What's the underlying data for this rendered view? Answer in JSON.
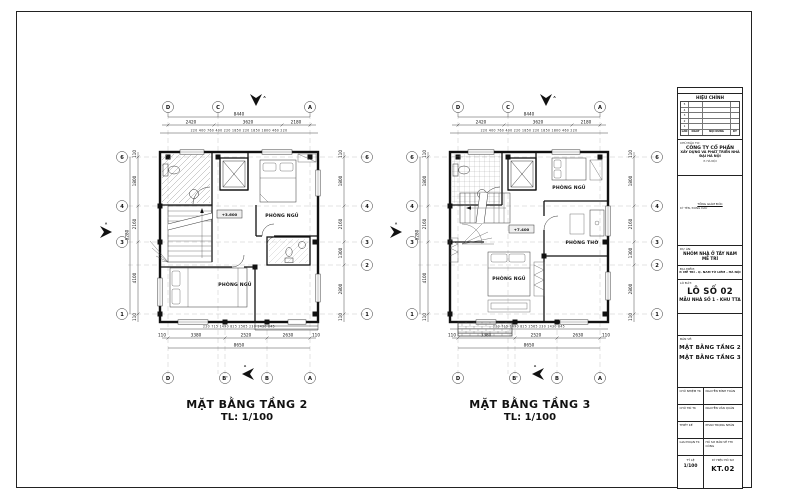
{
  "plans": [
    {
      "title": "MẶT BẰNG TẦNG 2",
      "scale": "TL: 1/100",
      "elevation": "+3.600",
      "section_label": "A",
      "rooms": {
        "bedroom1": "PHÒNG NGỦ",
        "bedroom2": "PHÒNG NGỦ"
      },
      "grid_top": [
        "D",
        "C",
        "A"
      ],
      "grid_bottom": [
        "D",
        "B'",
        "B",
        "A"
      ],
      "grid_left": [
        "6",
        "4",
        "3",
        "1"
      ],
      "grid_right": [
        "6",
        "4",
        "3",
        "2",
        "1"
      ],
      "dim_top_total": "8440",
      "dim_top_segments": [
        "2420",
        "3620",
        "2180"
      ],
      "dim_top_detail": [
        "220",
        "400",
        "760",
        "400",
        "220",
        "1850",
        "220",
        "1850",
        "1800",
        "460",
        "220"
      ],
      "dim_bottom_detail": [
        "220",
        "715",
        "1490",
        "825",
        "2565",
        "230",
        "1430",
        "845"
      ],
      "dim_bottom_segments": [
        "110",
        "3380",
        "2520",
        "2630",
        "110"
      ],
      "dim_bottom_total": "8650",
      "dim_left_segments": [
        "110",
        "1800",
        "2160",
        "4100",
        "110"
      ],
      "dim_left_total": "8280",
      "dim_right_segments": [
        "110",
        "1800",
        "2160",
        "1300",
        "2800",
        "110"
      ]
    },
    {
      "title": "MẶT BẰNG TẦNG 3",
      "scale": "TL: 1/100",
      "elevation": "+7.400",
      "section_label": "A",
      "rooms": {
        "bedroom1": "PHÒNG NGỦ",
        "altar": "PHÒNG THỜ",
        "bedroom2": "PHÒNG NGỦ"
      },
      "grid_top": [
        "D",
        "C",
        "A"
      ],
      "grid_bottom": [
        "D",
        "B'",
        "B",
        "A"
      ],
      "grid_left": [
        "6",
        "4",
        "3",
        "1"
      ],
      "grid_right": [
        "6",
        "4",
        "3",
        "2",
        "1"
      ],
      "dim_top_total": "8440",
      "dim_top_segments": [
        "2420",
        "3620",
        "2180"
      ],
      "dim_top_detail": [
        "220",
        "400",
        "760",
        "400",
        "220",
        "1850",
        "220",
        "1850",
        "1800",
        "460",
        "220"
      ],
      "dim_bottom_detail": [
        "220",
        "715",
        "1490",
        "825",
        "2565",
        "230",
        "1430",
        "845"
      ],
      "dim_bottom_segments": [
        "110",
        "3380",
        "2520",
        "2630",
        "110"
      ],
      "dim_bottom_total": "8650",
      "dim_left_segments": [
        "110",
        "1800",
        "2160",
        "4100",
        "110"
      ],
      "dim_left_total": "8280",
      "dim_right_segments": [
        "110",
        "1800",
        "2160",
        "1300",
        "2800",
        "110"
      ]
    }
  ],
  "titleblock": {
    "revision": {
      "header": "HIỆU CHỈNH",
      "columns": [
        "LẦN",
        "NGÀY",
        "NỘI DUNG",
        "KÝ"
      ],
      "row_numbers": [
        "5",
        "4",
        "3",
        "2",
        "1"
      ]
    },
    "investor_label": "CHỦ ĐẦU TƯ:",
    "company_line1": "CÔNG TY CỔ PHẦN",
    "company_line2": "XÂY DỰNG VÀ PHÁT TRIỂN NHÀ ĐẠI HÀ NỘI",
    "company_line3": "P. HÀ NỘI",
    "signature_title": "TỔNG GIÁM ĐỐC",
    "signature_note": "KÝ TÊN, ĐÓNG DẤU",
    "project_label": "DỰ ÁN:",
    "project_name": "NHÓM NHÀ Ở TÂY NAM MỄ TRÌ",
    "location_label": "ĐỊA ĐIỂM:",
    "location": "P. MỄ TRÌ - Q. NAM TỪ LIÊM - HÀ NỘI",
    "lot_label": "LÔ ĐẤT:",
    "lot_number": "LÔ SỐ 02",
    "lot_model": "MẪU NHÀ SỐ 1 - KHU TTA",
    "drawing_label": "BẢN VẼ:",
    "drawing_line1": "MẶT BẰNG TẦNG 2",
    "drawing_line2": "MẶT BẰNG TẦNG 3",
    "staff": [
      {
        "role": "CHỦ NHIỆM TK",
        "name": "NGUYỄN ĐÌNH TOÀN"
      },
      {
        "role": "CHỦ TRÌ TK",
        "name": "NGUYỄN VĂN QUÂN"
      },
      {
        "role": "THIẾT KẾ",
        "name": "PHAN TRỌNG NHÂN"
      },
      {
        "role": "GIAI ĐOẠN TK",
        "name": "HỒ SƠ BẢN VẼ THI CÔNG"
      }
    ],
    "scale_label": "TỶ LỆ",
    "scale_value": "1/100",
    "code_label": "KÝ HIỆU HỒ SƠ",
    "drawing_number": "KT.02"
  }
}
